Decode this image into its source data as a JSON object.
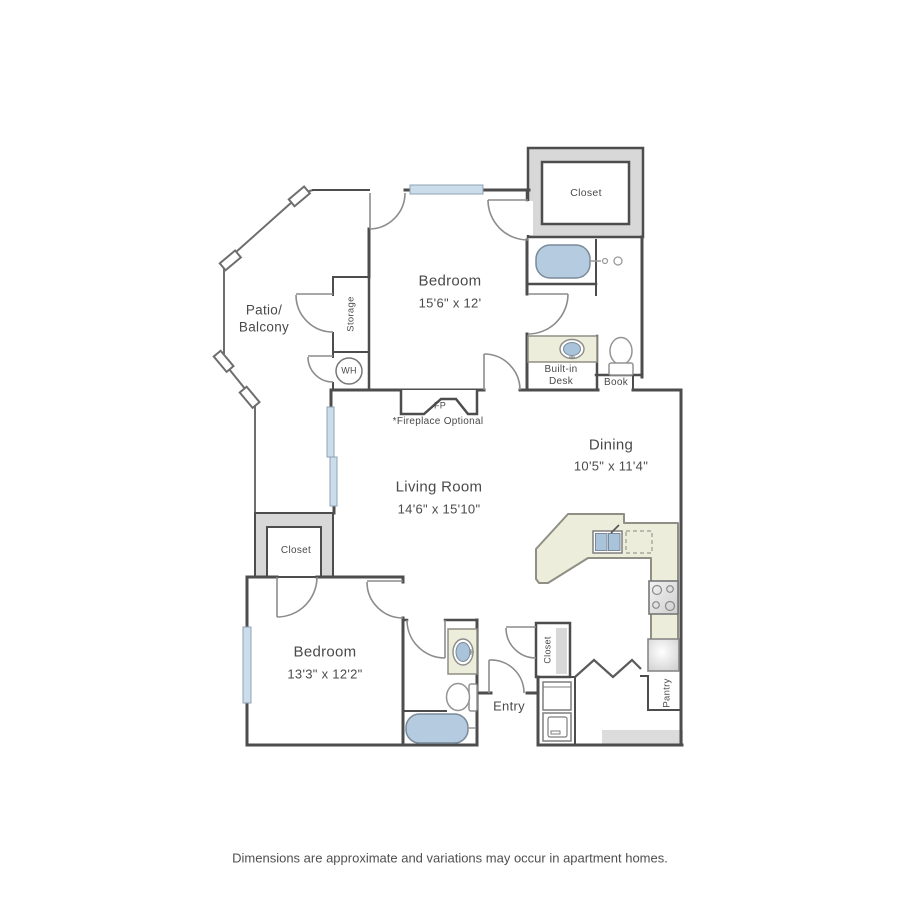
{
  "labels": {
    "bedroom1_name": "Bedroom",
    "bedroom1_dims": "15'6\" x 12'",
    "patio_line1": "Patio/",
    "patio_line2": "Balcony",
    "storage": "Storage",
    "water_heater": "WH",
    "fireplace": "FP",
    "fireplace_note": "*Fireplace Optional",
    "living_name": "Living Room",
    "living_dims": "14'6\" x 15'10\"",
    "dining_name": "Dining",
    "dining_dims": "10'5\" x 11'4\"",
    "closet_master": "Closet",
    "built_in_desk_line1": "Built-in",
    "built_in_desk_line2": "Desk",
    "book": "Book",
    "closet_bedroom2": "Closet",
    "bedroom2_name": "Bedroom",
    "bedroom2_dims": "13'3\" x 12'2\"",
    "entry": "Entry",
    "closet_entry": "Closet",
    "pantry": "Pantry"
  },
  "footer": {
    "disclaimer": "Dimensions are approximate and variations may occur in apartment homes."
  },
  "colors": {
    "wall": "#4d4d4d",
    "door": "#8c8c8c",
    "fixture_blue": "#b5cce0",
    "counter_cream": "#ededdb",
    "closet_gray": "#d8d8d8",
    "window_blue": "#cbdcea",
    "text": "#4a4a4a"
  }
}
